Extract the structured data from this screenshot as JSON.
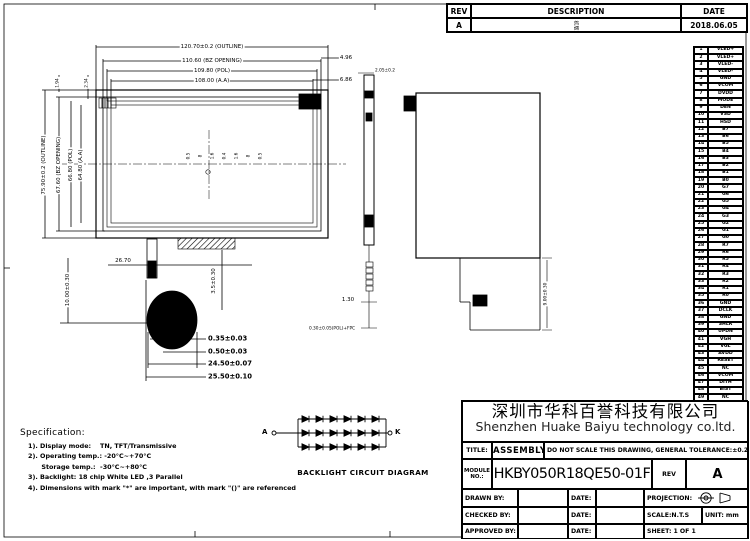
{
  "rev_table": {
    "headers": [
      "REV",
      "DESCRIPTION",
      "DATE"
    ],
    "row": {
      "rev": "A",
      "description": "初版",
      "date": "2018.06.05"
    }
  },
  "pins": [
    [
      "1",
      "VLED+"
    ],
    [
      "2",
      "VLED+"
    ],
    [
      "3",
      "VLED-"
    ],
    [
      "4",
      "VLED-"
    ],
    [
      "5",
      "GND"
    ],
    [
      "6",
      "VCOM"
    ],
    [
      "7",
      "DVDD"
    ],
    [
      "8",
      "MODE"
    ],
    [
      "9",
      "DEN"
    ],
    [
      "10",
      "VSD"
    ],
    [
      "11",
      "HSD"
    ],
    [
      "12",
      "B7"
    ],
    [
      "13",
      "B6"
    ],
    [
      "14",
      "B5"
    ],
    [
      "15",
      "B4"
    ],
    [
      "16",
      "B3"
    ],
    [
      "17",
      "B2"
    ],
    [
      "18",
      "B1"
    ],
    [
      "19",
      "B0"
    ],
    [
      "20",
      "G7"
    ],
    [
      "21",
      "G6"
    ],
    [
      "22",
      "G5"
    ],
    [
      "23",
      "G4"
    ],
    [
      "24",
      "G3"
    ],
    [
      "25",
      "G2"
    ],
    [
      "26",
      "G1"
    ],
    [
      "27",
      "G0"
    ],
    [
      "28",
      "R7"
    ],
    [
      "29",
      "R6"
    ],
    [
      "30",
      "R5"
    ],
    [
      "31",
      "R4"
    ],
    [
      "32",
      "R3"
    ],
    [
      "33",
      "R2"
    ],
    [
      "34",
      "R1"
    ],
    [
      "35",
      "R0"
    ],
    [
      "36",
      "GND"
    ],
    [
      "37",
      "DCLK"
    ],
    [
      "38",
      "GND"
    ],
    [
      "39",
      "SHLR"
    ],
    [
      "40",
      "UPDN"
    ],
    [
      "41",
      "VGH"
    ],
    [
      "42",
      "VGL"
    ],
    [
      "43",
      "AVDD"
    ],
    [
      "44",
      "RESET"
    ],
    [
      "45",
      "NC"
    ],
    [
      "46",
      "VCOM"
    ],
    [
      "47",
      "DITH"
    ],
    [
      "48",
      "BIST"
    ],
    [
      "49",
      "NC"
    ],
    [
      "50",
      "NC"
    ]
  ],
  "front_view": {
    "dim_top": [
      "120.70±0.2 (OUTLINE)",
      "110.60 (BZ OPENING)",
      "109.80 (POL)",
      "108.00 (A.A)"
    ],
    "dim_right": [
      "4.96",
      "6.86"
    ],
    "dim_left": [
      "75.90±0.2 (OUTLINE)",
      "67.60 (BZ OPENING)",
      "66.80 (POL)",
      "64.80 (A.A)"
    ],
    "dim_left_top": [
      "1.94",
      "2.34"
    ],
    "center_labels": [
      "0.5",
      "8",
      "1.6",
      "0.4",
      "1.6",
      "8",
      "0.5"
    ],
    "dim_bottom": {
      "w_fpc": "26.70",
      "h_fpc": "10.00±0.30",
      "h_tail": "3.5±0.30",
      "stack": [
        "0.35±0.03",
        "0.50±0.03",
        "24.50±0.07",
        "25.50±0.10"
      ]
    }
  },
  "side_view": {
    "dim_top": "2.05±0.2",
    "dim_fpc": "1.30",
    "dim_bottom": "0.30±0.05(POL)+FPC"
  },
  "back_view": {
    "dim_right": "9.00±0.30"
  },
  "backlight": {
    "label_a": "A",
    "label_k": "K",
    "title": "BACKLIGHT CIRCUIT DIAGRAM",
    "rows": 3,
    "diodes_per_row": 6
  },
  "spec": {
    "title": "Specification:",
    "items": [
      "1). Display mode:    TN, TFT/Transmissive",
      "2). Operating temp.: -20°C~+70°C",
      "      Storage temp.:  -30°C~+80°C",
      "3). Backlight: 18 chip White LED ,3 Parallel",
      "4). Dimensions with mark \"*\" are important, with mark \"()\" are referenced"
    ]
  },
  "title_block": {
    "company_cn": "深圳市华科百誉科技有限公司",
    "company_en": "Shenzhen Huake Baiyu technology co.ltd.",
    "title_label": "TITLE:",
    "title_value": "ASSEMBLY",
    "note": "DO NOT SCALE THIS DRAWING, GENERAL TOLERANCE:±0.2",
    "module_label": "MODULE NO.:",
    "module_value": "HKBY050R18QE50-01F",
    "rev_label": "REV",
    "rev_value": "A",
    "drawn_label": "DRAWN BY:",
    "checked_label": "CHECKED BY:",
    "approved_label": "APPROVED BY:",
    "date_label": "DATE:",
    "projection_label": "PROJECTION:",
    "scale_label": "SCALE:N.T.S",
    "unit_label": "UNIT:",
    "unit_value": "mm",
    "sheet_label": "SHEET:",
    "sheet_value": "1   OF   1"
  }
}
